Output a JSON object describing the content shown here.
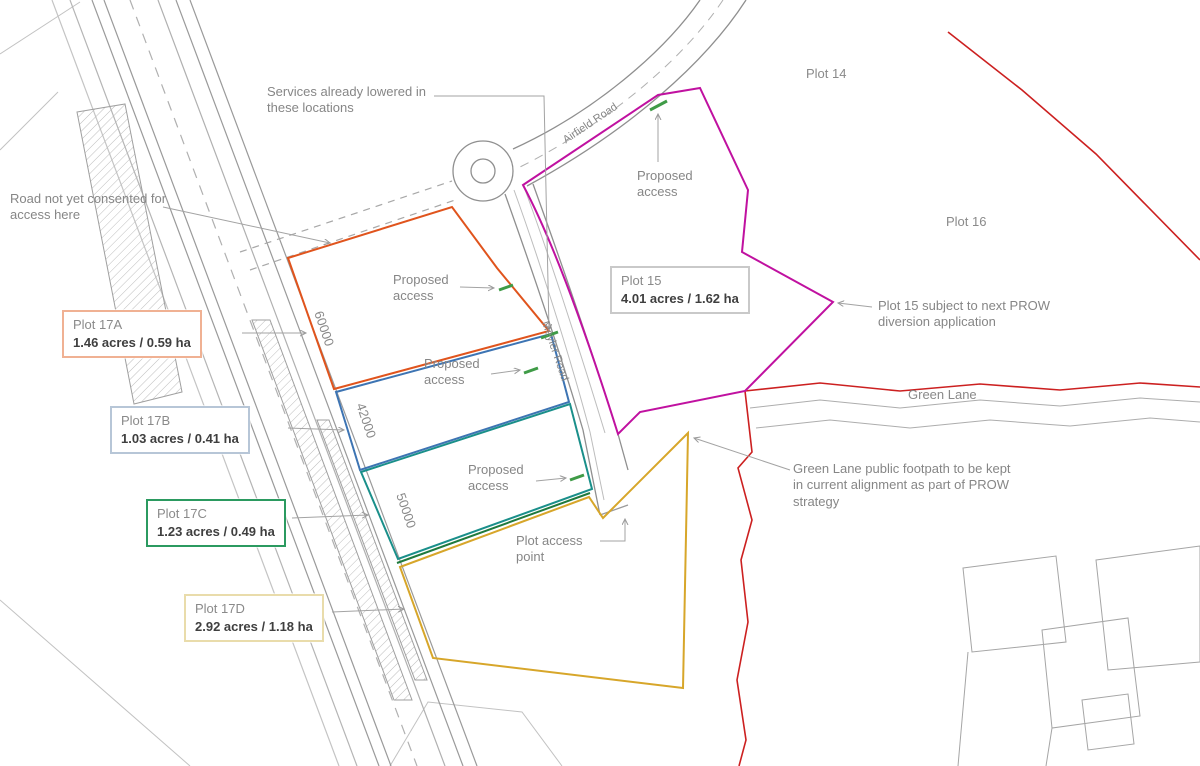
{
  "plan": {
    "plots": {
      "boxes": [
        {
          "name": "Plot 17A",
          "area": "1.46 acres / 0.59 ha"
        },
        {
          "name": "Plot 17B",
          "area": "1.03 acres / 0.41 ha"
        },
        {
          "name": "Plot 17C",
          "area": "1.23 acres / 0.49 ha"
        },
        {
          "name": "Plot 17D",
          "area": "2.92 acres / 1.18 ha"
        },
        {
          "name": "Plot 15",
          "area": "4.01 acres / 1.62 ha"
        }
      ],
      "plot14": "Plot 14",
      "plot16": "Plot 16"
    },
    "roads": {
      "airfield": "Airfield Road",
      "meyler": "Meyler Road",
      "green_lane": "Green Lane"
    },
    "dimensions": {
      "d1": "60000",
      "d2": "42000",
      "d3": "50000"
    },
    "notes": {
      "services": "Services already lowered in these locations",
      "road_not_consented": "Road not yet consented for access here",
      "proposed_access": "Proposed access",
      "plot15_prow": "Plot 15 subject to next PROW diversion application",
      "green_lane_footpath": "Green Lane public footpath to be kept in current alignment as part of PROW strategy",
      "plot_access_point": "Plot access point"
    },
    "colors": {
      "plot_17a_line": "#e0541d",
      "plot_17b_line": "#3d74b3",
      "plot_17c_line": "#1a8f8a",
      "plot_17c_south_line": "#1f7a3d",
      "plot_17d_line": "#d7a62a",
      "plot_15_line": "#c011a0",
      "site_boundary_red": "#cc2020",
      "services_tick_green": "#3f9b47",
      "linework_grey": "#8c8c8c"
    }
  }
}
